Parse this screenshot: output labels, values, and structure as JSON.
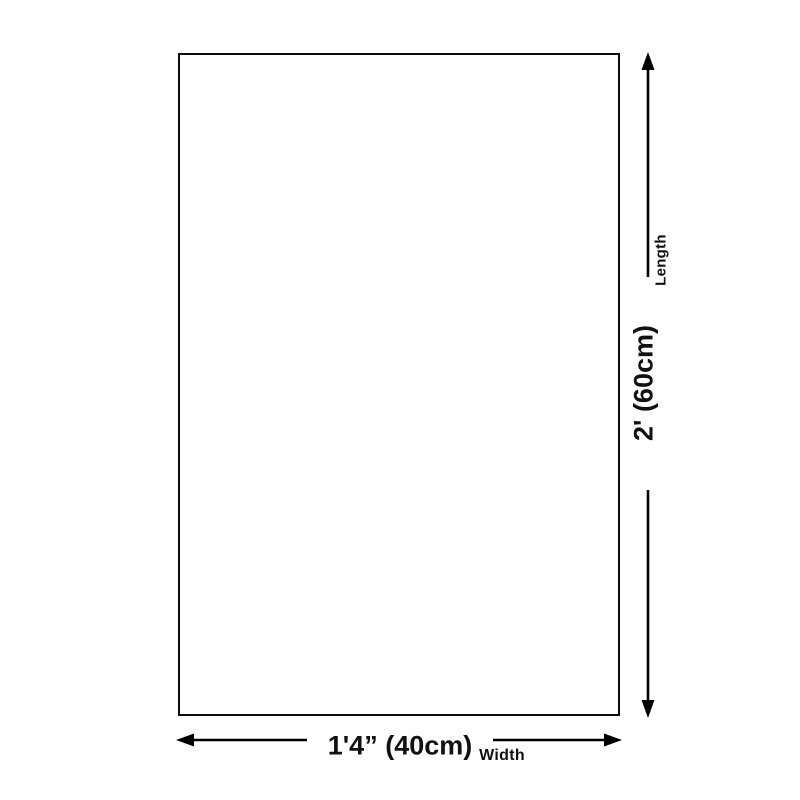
{
  "diagram": {
    "colors": {
      "background": "#ffffff",
      "line": "#000000",
      "text": "#111111"
    },
    "length": {
      "label": "Length",
      "value": "2' (60cm)"
    },
    "width": {
      "label": "Width",
      "value": "1'4” (40cm)"
    }
  }
}
